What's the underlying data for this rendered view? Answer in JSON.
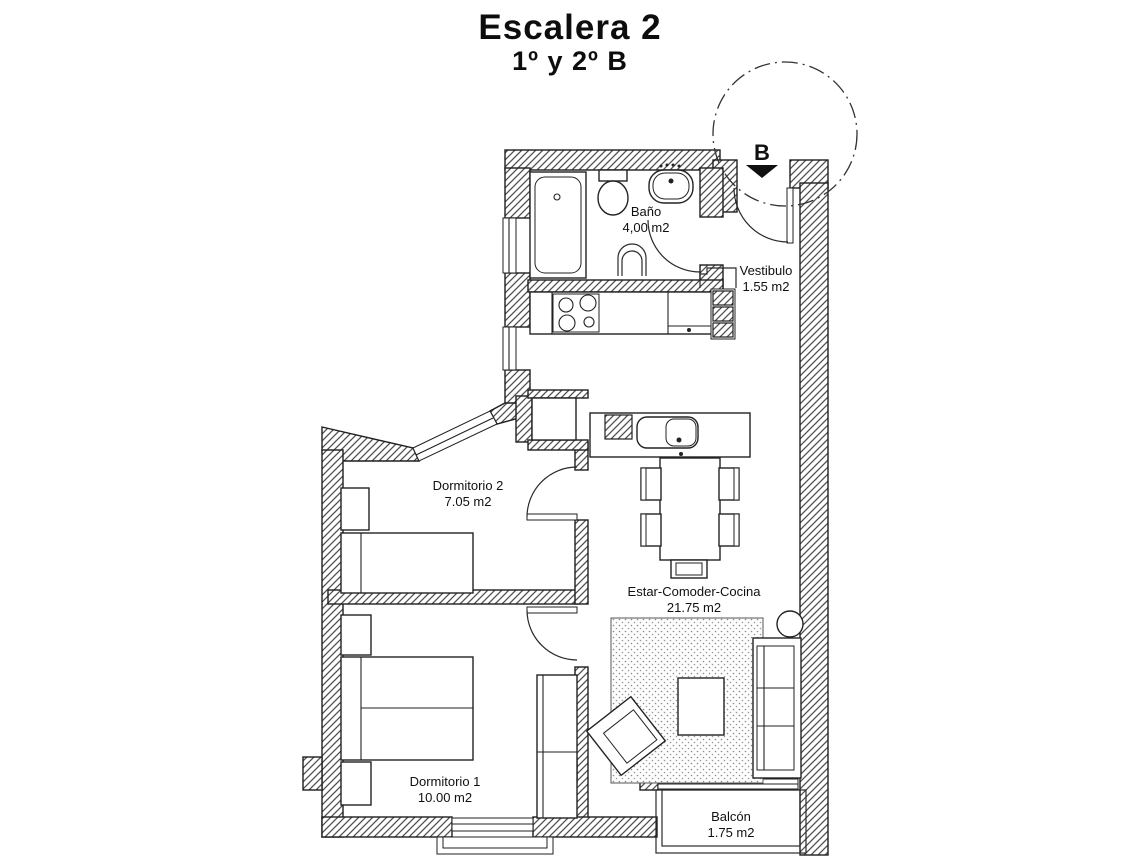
{
  "header": {
    "title": "Escalera 2",
    "subtitle": "1º y 2º B"
  },
  "plan": {
    "stair_marker": "B",
    "rooms": [
      {
        "id": "bano",
        "name": "Baño",
        "area": "4,00 m2"
      },
      {
        "id": "vestibulo",
        "name": "Vestibulo",
        "area": "1.55 m2"
      },
      {
        "id": "dormitorio2",
        "name": "Dormitorio 2",
        "area": "7.05 m2"
      },
      {
        "id": "estar",
        "name": "Estar-Comoder-Cocina",
        "area": "21.75 m2"
      },
      {
        "id": "dormitorio1",
        "name": "Dormitorio 1",
        "area": "10.00 m2"
      },
      {
        "id": "balcon",
        "name": "Balcón",
        "area": "1.75 m2"
      }
    ],
    "fixtures": [
      "bathtub",
      "toilet",
      "washbasin",
      "bidet",
      "hob-4-burner",
      "kitchen-sink",
      "appliance-shaft",
      "dining-table",
      "chair",
      "sofa",
      "armchair",
      "coffee-table",
      "side-table",
      "rug",
      "single-bed",
      "double-bed",
      "nightstand",
      "wardrobe"
    ],
    "colors": {
      "line": "#1f1f1f",
      "hatch": "#4f4f4f",
      "paper": "#ffffff",
      "text": "#101010"
    }
  }
}
